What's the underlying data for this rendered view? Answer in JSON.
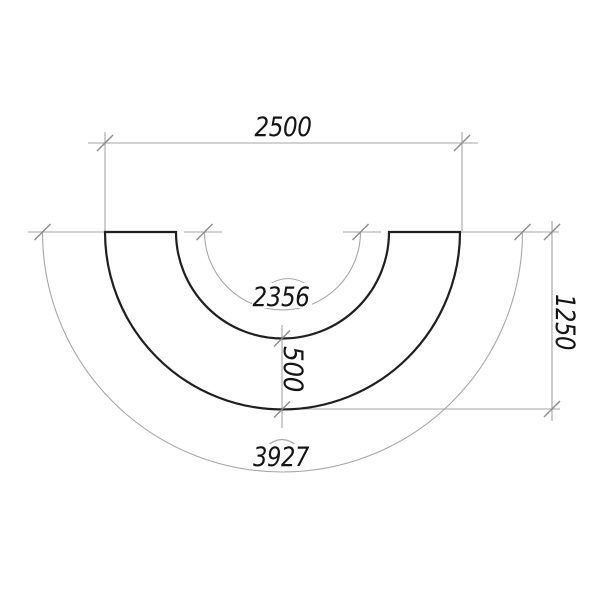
{
  "drawing": {
    "kind": "half-annulus technical drawing",
    "dimensions": {
      "top_width": {
        "value": "2500",
        "type": "linear-horizontal"
      },
      "inner_arc_length": {
        "value": "2356",
        "type": "arc-length",
        "symbol": "arc-cap"
      },
      "ring_width": {
        "value": "500",
        "type": "linear-vertical"
      },
      "radius_height": {
        "value": "1250",
        "type": "linear-vertical"
      },
      "outer_arc_length": {
        "value": "3927",
        "type": "arc-length",
        "symbol": "arc-cap"
      }
    },
    "colors": {
      "outline": "#1f1f1f",
      "dimension_lines": "#a6a6a6",
      "ticks": "#8c8c8c",
      "text": "#141414",
      "background": "#ffffff"
    }
  }
}
